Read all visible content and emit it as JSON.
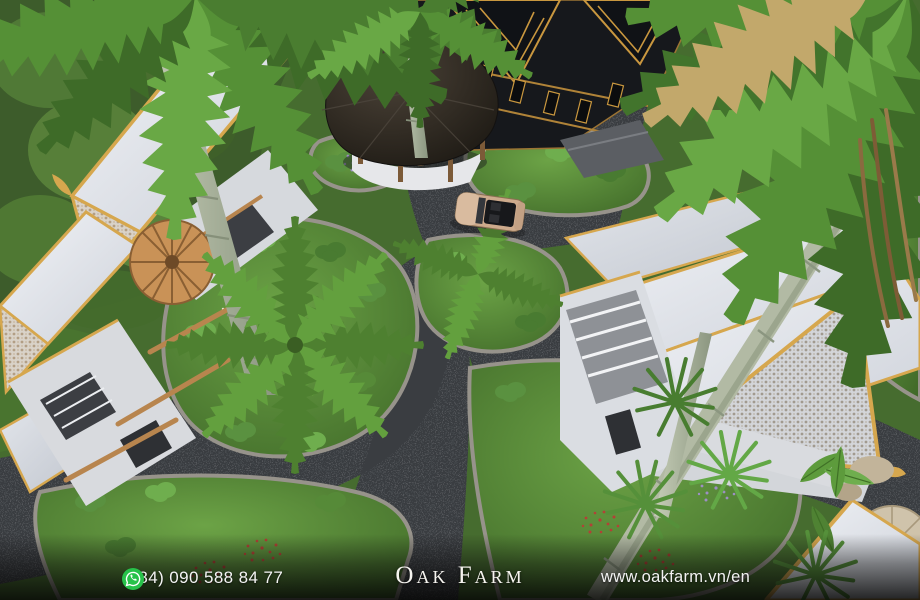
{
  "scene": {
    "type": "aerial-3d-architectural-render",
    "subject": "Tropical resort with Thai-style villas, gold-trimmed roofs, palm trees, garden islands, stone pathways, a gazebo and a parked convertible car",
    "elements": [
      "white-villa-roofs-with-gold-trim",
      "ornate-gable-carvings",
      "black-pavilion-with-gold-ornaments",
      "round-dark-roof-gazebo",
      "palm-tree-canopies-and-trunks",
      "garden-islands-with-shrubs-and-flowers",
      "dark-stone-walkways",
      "beige-convertible-car",
      "wooden-parasol-deck",
      "bamboo-ladder-poles"
    ]
  },
  "footer": {
    "phone": "(+84) 090 588 84 77",
    "brand": "Oak Farm",
    "website": "www.oakfarm.vn/en"
  },
  "icons": {
    "whatsapp": "whatsapp-icon"
  },
  "colors": {
    "roof_gold": "#d6a74e",
    "roof_white": "#e4e7ec",
    "dark_building": "#16181c",
    "pathway": "#3a3d41",
    "garden_green": "#4e7a33",
    "whatsapp_green": "#27c24a",
    "footer_text": "#f4f4f4"
  }
}
